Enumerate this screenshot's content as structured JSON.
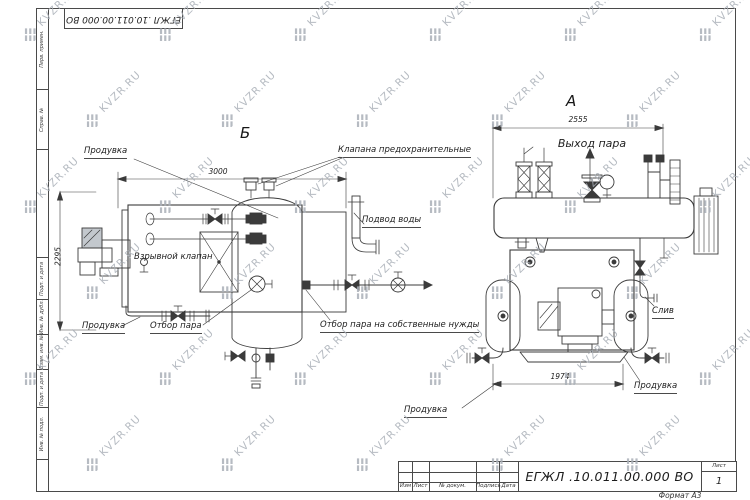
{
  "sheet": {
    "stamp_top": "ЕГЖЛ .10.011.00.000  ВО",
    "format_label": "Формат А3",
    "margin_labels": [
      "Перв. примен.",
      "Справ. №",
      "Подп. и дата",
      "Инв. № дубл.",
      "Взам. инв. №",
      "Подп. и дата",
      "Инв. № подл."
    ],
    "title_block": {
      "columns": [
        "Изм",
        "Лист",
        "№ докум.",
        "Подпись",
        "Дата"
      ],
      "doc_number": "ЕГЖЛ .10.011.00.000  ВО",
      "sheet_label": "Лист",
      "sheet_number": "1"
    }
  },
  "watermark": {
    "text": "KVZR.RU"
  },
  "views": {
    "left": {
      "label": "Б",
      "dim_length": "3000",
      "dim_height": "2295",
      "callouts": {
        "blowdown_top": "Продувка",
        "safety_valves": "Клапана предохранительные",
        "explosion_valve": "Взрывной клапан",
        "water_supply": "Подвод воды",
        "blowdown_bottom": "Продувка",
        "steam_takeoff": "Отбор пара",
        "steam_own_needs": "Отбор пара на собственные нужды"
      }
    },
    "front": {
      "label": "А",
      "dim_width": "2555",
      "dim_base": "1974",
      "callouts": {
        "steam_outlet": "Выход пара",
        "drain": "Слив",
        "blowdown": "Продувка"
      }
    },
    "center_callout": "Продувка"
  }
}
